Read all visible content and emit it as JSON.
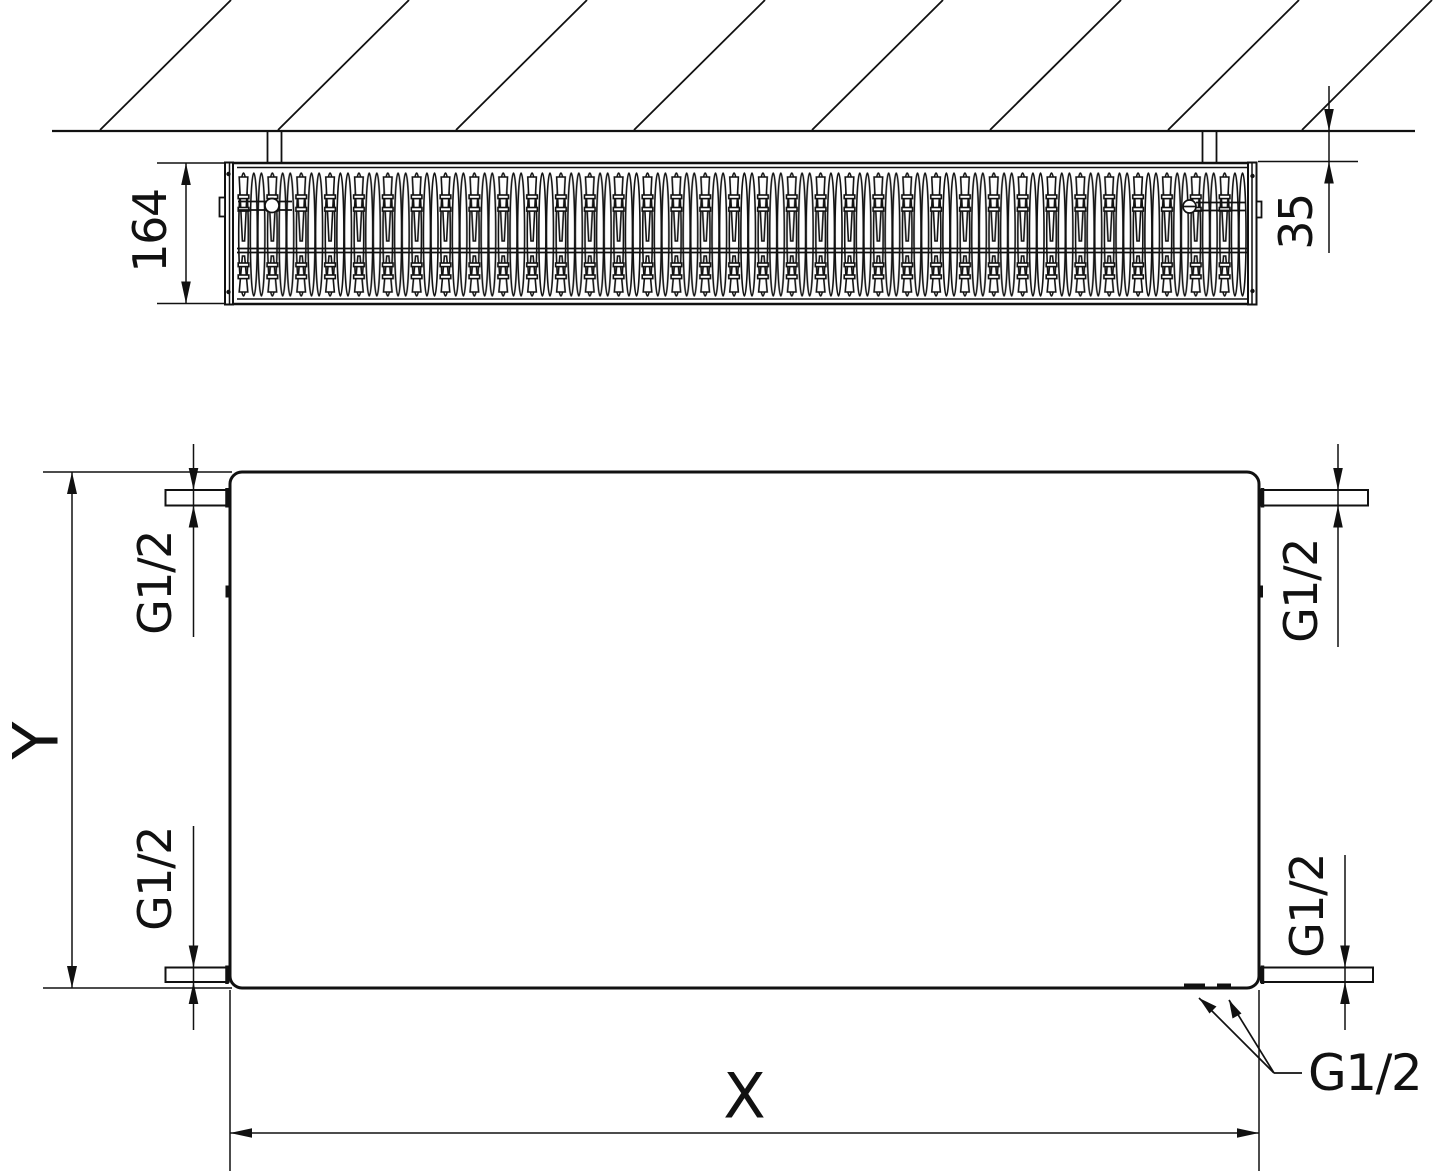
{
  "drawing_type": "radiator dimensional technical drawing",
  "colors": {
    "line": "#111111",
    "background": "#ffffff"
  },
  "top_view": {
    "depth": "164",
    "wall_distance": "35"
  },
  "front_view": {
    "height": "Y",
    "width": "X",
    "ports": {
      "top_left": "G1/2",
      "bottom_left": "G1/2",
      "top_right": "G1/2",
      "bottom_right": "G1/2",
      "bottom": "G1/2"
    }
  }
}
